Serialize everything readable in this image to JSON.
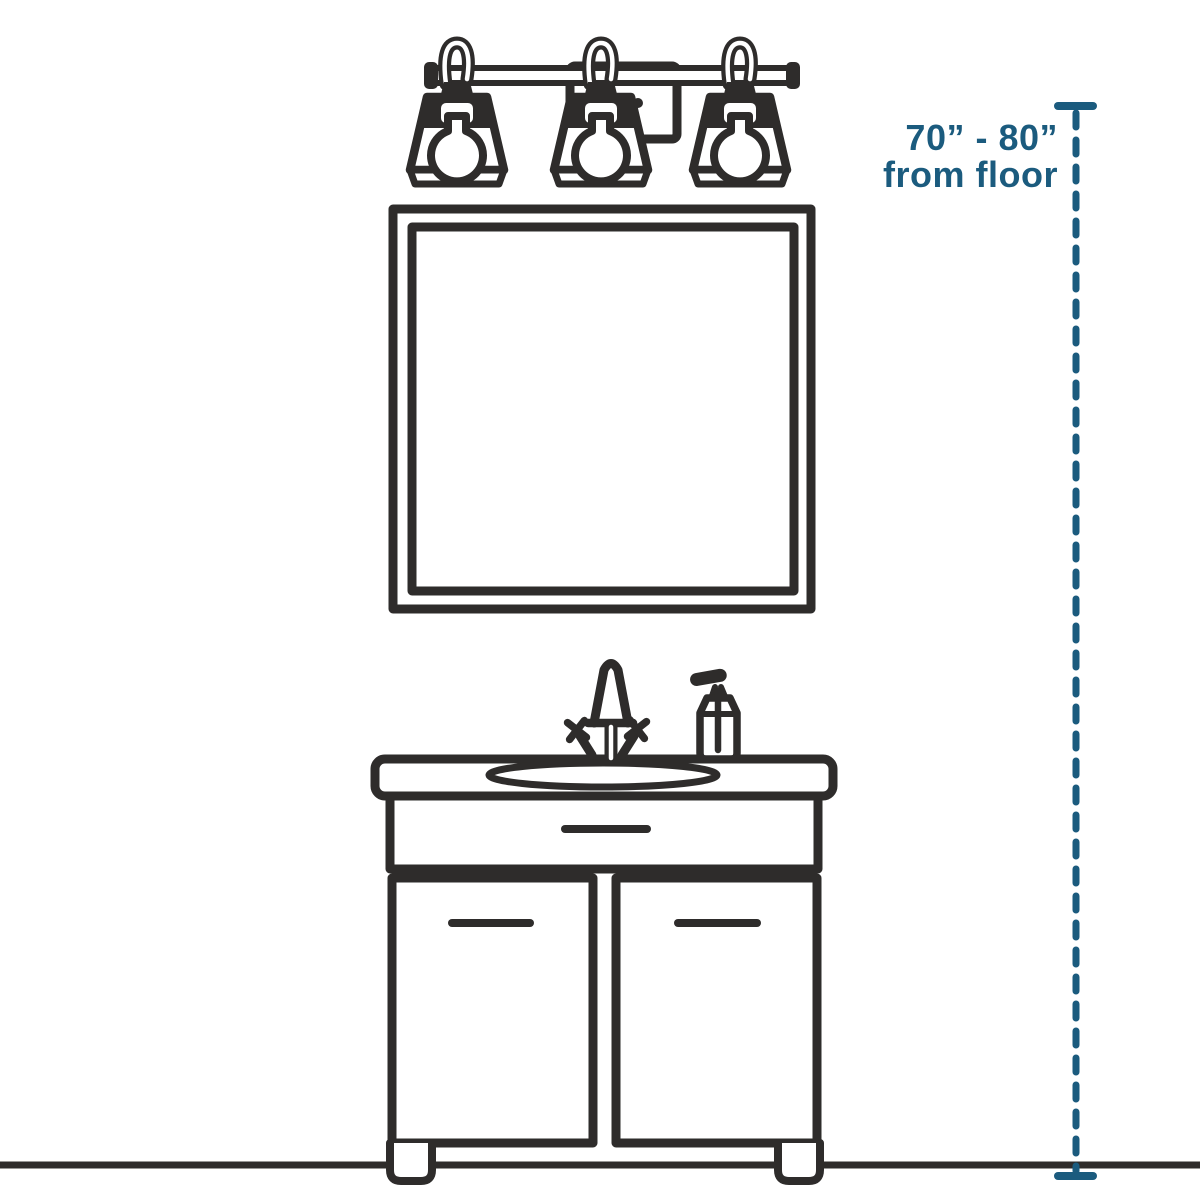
{
  "annotation": {
    "range_label": "70” - 80”",
    "reference_label": "from floor"
  },
  "colors": {
    "ink": "#2e2c2b",
    "measure": "#1b5b7e",
    "background": "#ffffff"
  },
  "icons": {
    "light_fixture": "three-light-vanity-fixture",
    "mirror": "square-framed-mirror",
    "faucet": "cross-handle-faucet",
    "soap_dispenser": "pump-soap-bottle",
    "vanity": "two-door-vanity-cabinet-with-drawer",
    "floor": "floor-line",
    "measurement": "dashed-height-measurement-line"
  }
}
